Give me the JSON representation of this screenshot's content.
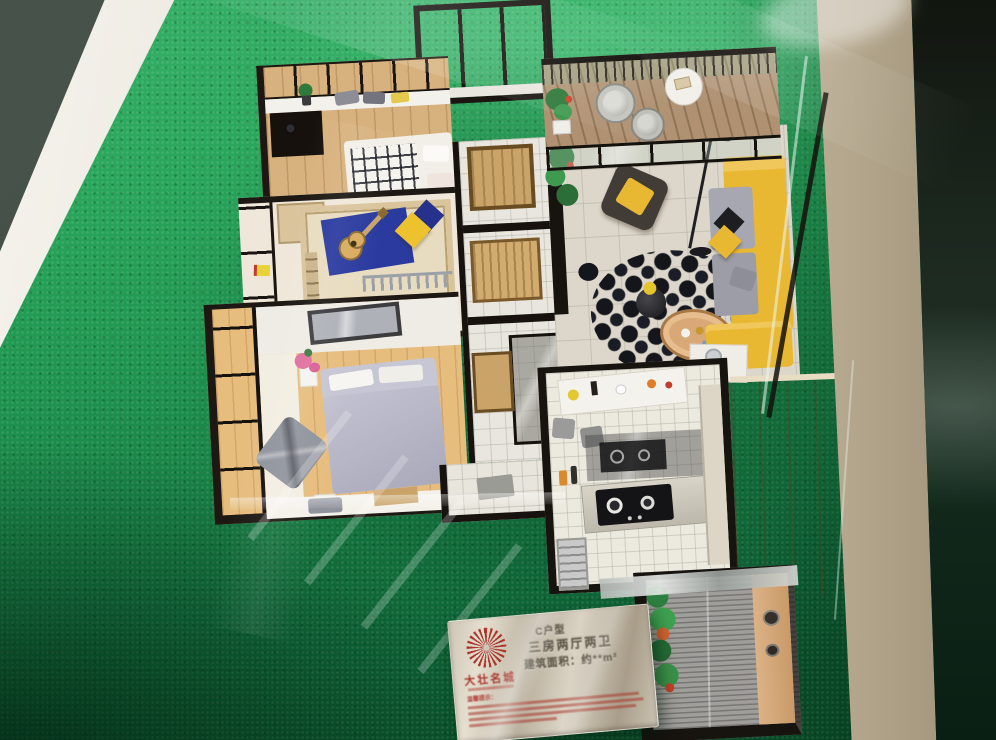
{
  "scene": {
    "subject": "Photograph of an architectural sales scale model of a C-type apartment (three bedrooms, two living areas, two baths) inside a glass display case on bright green artificial turf, with an engraved metal specification plaque in front",
    "rooms": [
      "top-bedroom",
      "kids-bedroom",
      "master-bedroom",
      "hallway-and-baths",
      "living-room",
      "lounge-balcony",
      "kitchen-dining",
      "service-balcony",
      "wardrobe-cabinet",
      "entry"
    ]
  },
  "plaque": {
    "logo": "sunburst-flower-icon",
    "brand_name": "大壮名城",
    "unit_code": "C户型",
    "unit_layout": "三房两厅两卫",
    "unit_area": "建筑面积：约**m²",
    "fine_print_header": "温馨提示：",
    "fine_print_line_count": 4
  },
  "palette": {
    "turf_green": "#1f8f4e",
    "model_wall_dark": "#17130f",
    "sofa_yellow": "#e9b833",
    "kids_mat_blue": "#2a3a9f",
    "master_bed_gray": "#bcbccb",
    "wood_floor": "#d8b27e",
    "plaque_silver": "#c9c2b4",
    "logo_red": "#a8342a"
  }
}
